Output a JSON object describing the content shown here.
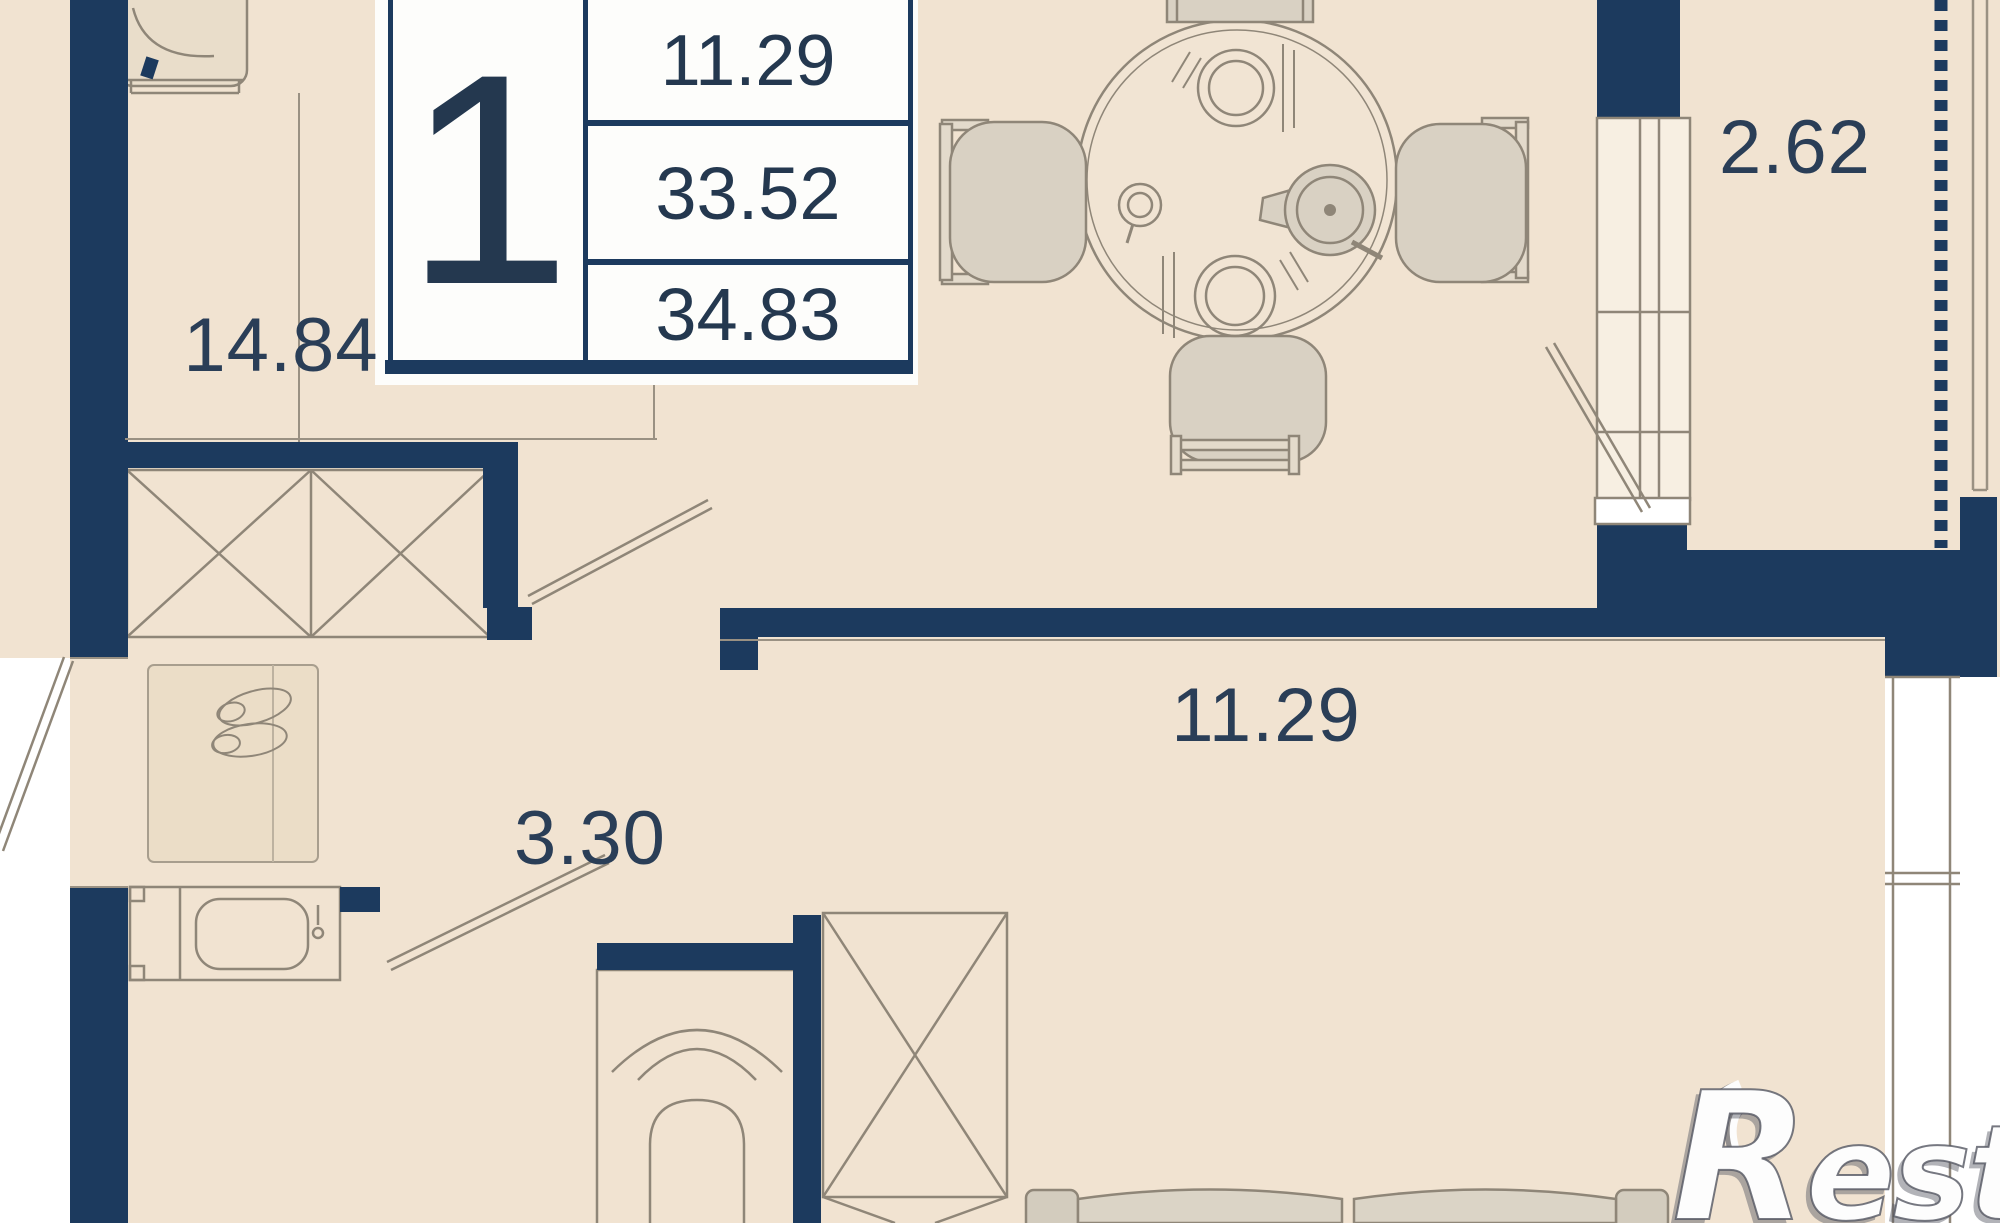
{
  "plan_type": "apartment-floor-plan",
  "legend": {
    "rooms_count": "1",
    "values": [
      "11.29",
      "33.52",
      "34.83"
    ]
  },
  "labels": {
    "room_main": "14.84",
    "hallway": "3.30",
    "living": "11.29",
    "balcony": "2.62"
  },
  "watermark": "Restate",
  "colors": {
    "wall": "#1c3a5e",
    "floor": "#f1e3d1",
    "furniture_line": "#8f8678",
    "label_text": "#2a3e57",
    "exterior": "#ffffff"
  }
}
